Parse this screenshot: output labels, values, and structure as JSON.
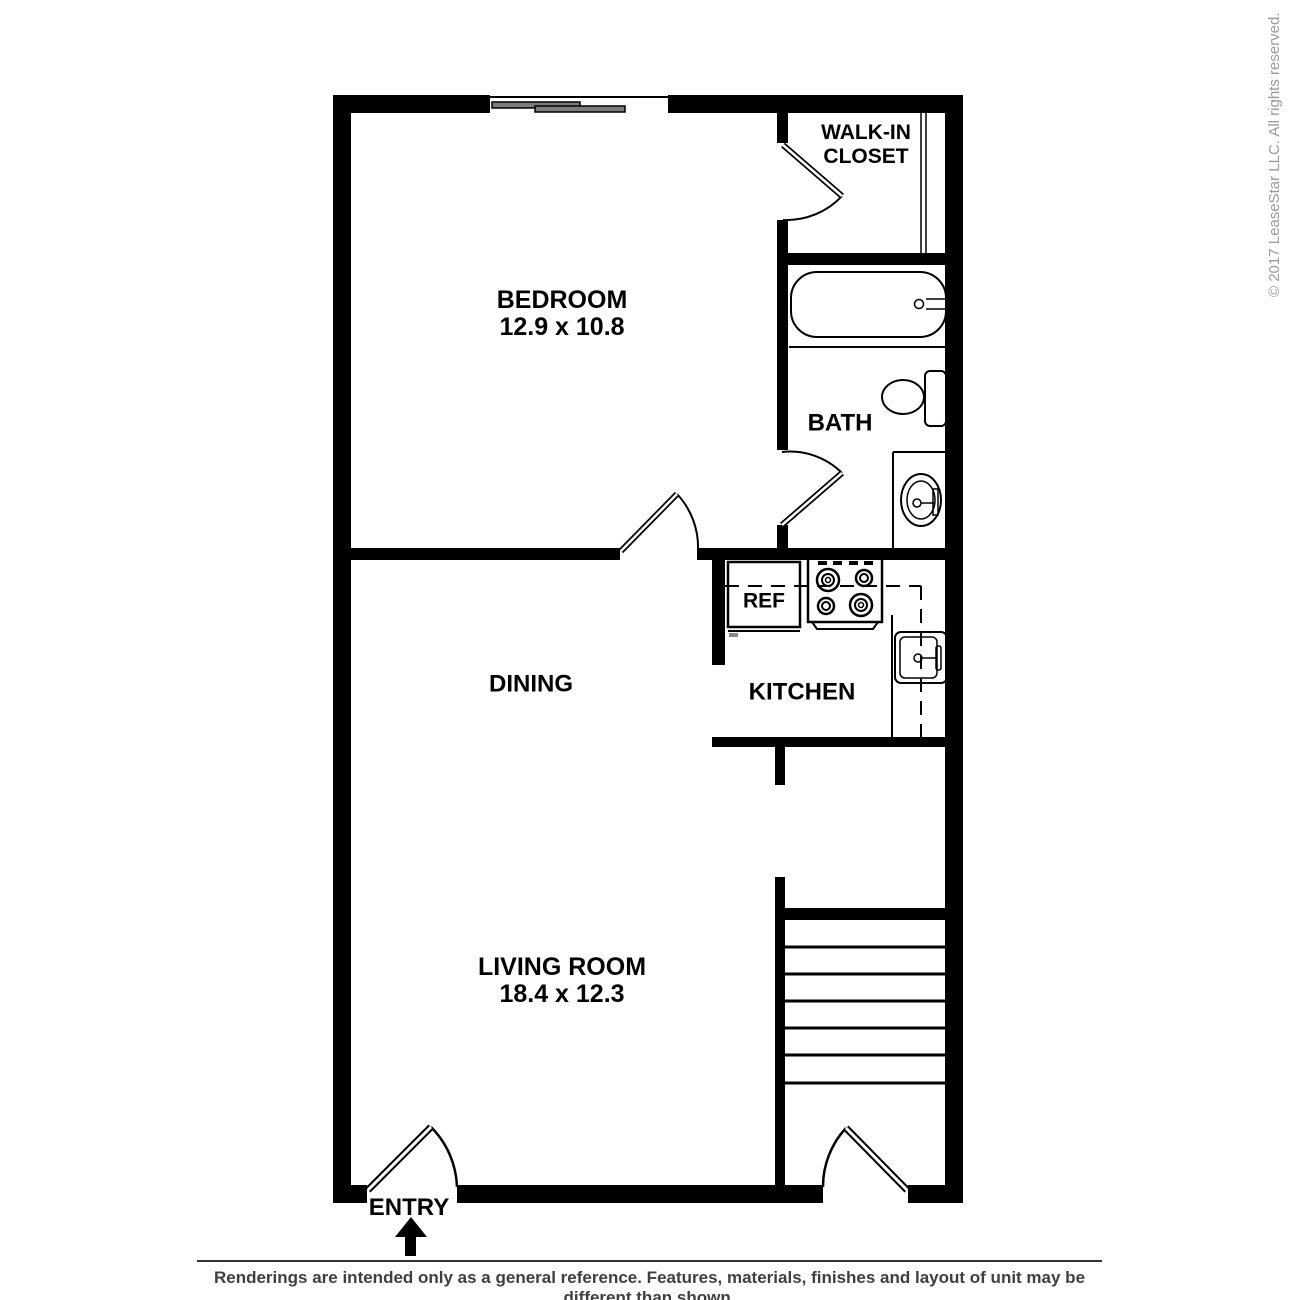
{
  "floor_plan": {
    "rooms": {
      "bedroom": {
        "name": "BEDROOM",
        "dimensions": "12.9 x 10.8"
      },
      "walk_in_closet": {
        "name_line1": "WALK-IN",
        "name_line2": "CLOSET"
      },
      "bath": {
        "name": "BATH"
      },
      "dining": {
        "name": "DINING"
      },
      "kitchen": {
        "name": "KITCHEN"
      },
      "living_room": {
        "name": "LIVING ROOM",
        "dimensions": "18.4 x 12.3"
      },
      "entry": {
        "name": "ENTRY"
      }
    },
    "appliances": {
      "refrigerator_label": "REF"
    }
  },
  "watermark": {
    "copyright": "© 2017 LeaseStar LLC. All rights reserved."
  },
  "footer": {
    "disclaimer": "Renderings are intended only as a general reference. Features, materials, finishes and layout of unit may be different than shown."
  },
  "colors": {
    "wall": "#000000",
    "window_panel": "#7d7d7d",
    "watermark_text": "#9b9b9b",
    "disclaimer_text": "#3f3f3f",
    "background": "#ffffff"
  }
}
